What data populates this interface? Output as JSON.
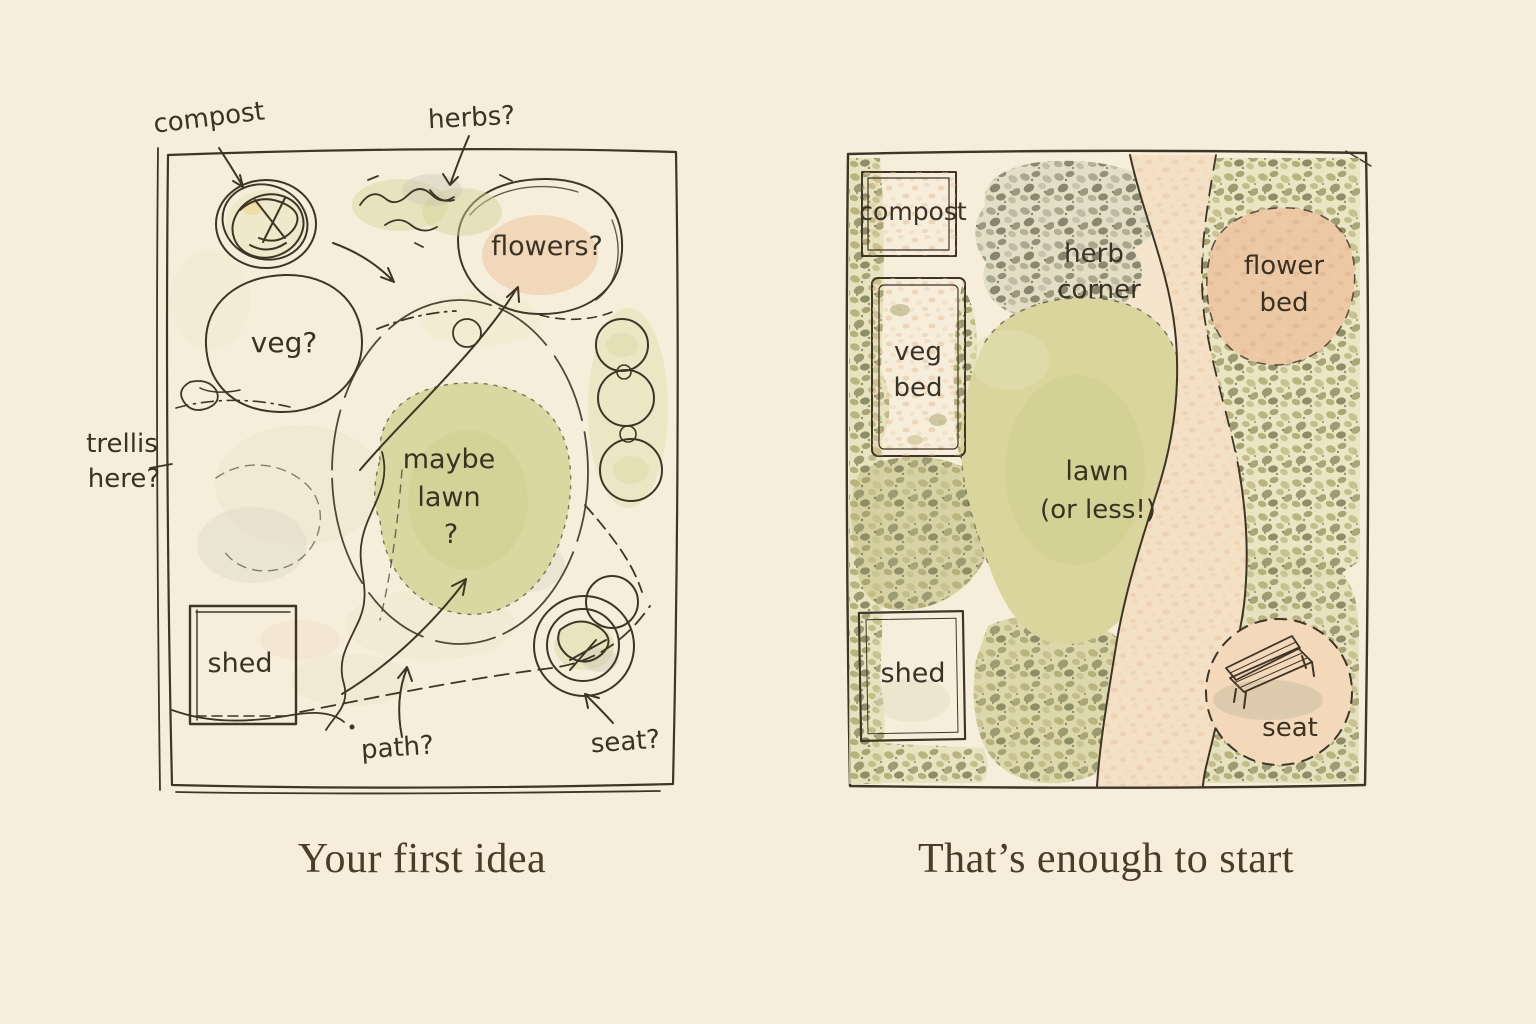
{
  "illustration": {
    "left": {
      "caption": "Your first idea",
      "labels": {
        "compost": "compost",
        "herbs": "herbs?",
        "flowers": "flowers?",
        "veg": "veg?",
        "lawn_line1": "maybe",
        "lawn_line2": "lawn",
        "lawn_line3": "?",
        "trellis_line1": "trellis",
        "trellis_line2": "here?",
        "shed": "shed",
        "path": "path?",
        "seat": "seat?"
      }
    },
    "right": {
      "caption": "That’s enough to start",
      "labels": {
        "compost": "compost",
        "veg_line1": "veg",
        "veg_line2": "bed",
        "herb_line1": "herb",
        "herb_line2": "corner",
        "flower_line1": "flower",
        "flower_line2": "bed",
        "lawn_line1": "lawn",
        "lawn_line2": "(or less!)",
        "shed": "shed",
        "seat": "seat"
      }
    },
    "colors": {
      "paper": "#f6eeda",
      "panel_paper": "#f9f3e2",
      "ink": "#3e3526",
      "lawn_green": "#d9d59c",
      "bed_pink": "#e9c3a0",
      "flower_pink": "#ecc8a5",
      "path_cream": "#f4e0c5",
      "shrub_olive": "#b0ab79"
    }
  }
}
